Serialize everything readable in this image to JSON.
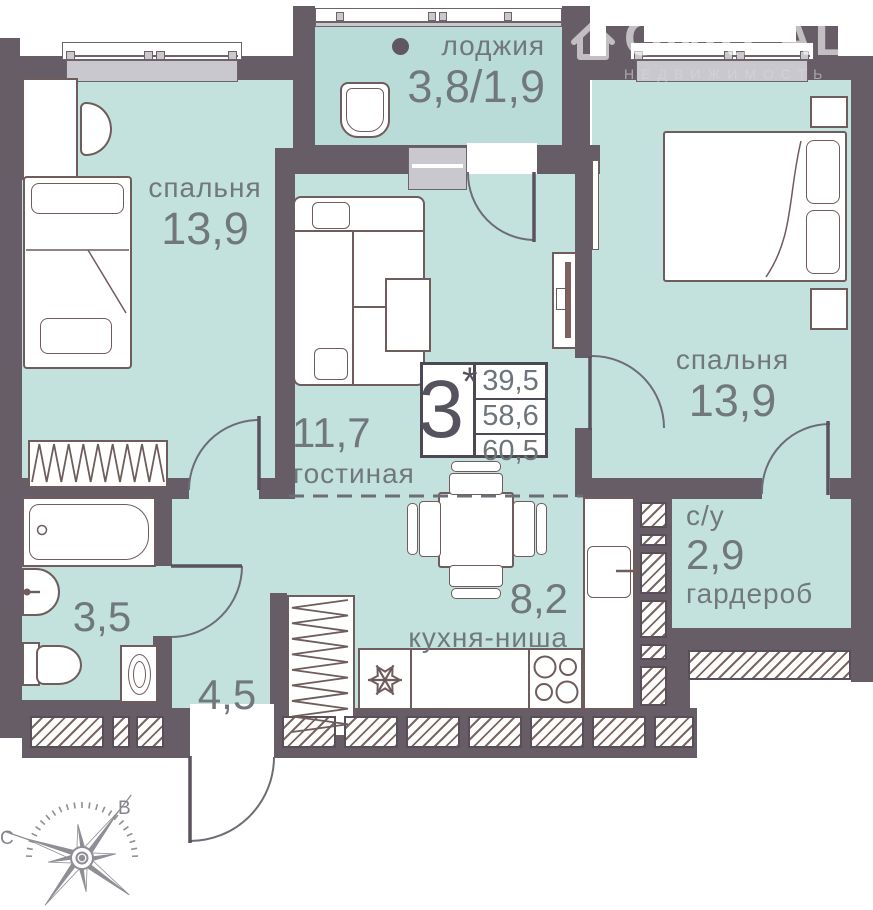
{
  "watermark": {
    "brand": "ONREAL",
    "subtitle": "НЕДВИЖИМОСТЬ"
  },
  "rooms": {
    "loggia": {
      "name": "лоджия",
      "area": "3,8/1,9"
    },
    "bedroom_left": {
      "name": "спальня",
      "area": "13,9"
    },
    "bedroom_right": {
      "name": "спальня",
      "area": "13,9"
    },
    "living_room": {
      "name": "гостиная",
      "area": "11,7"
    },
    "kitchen": {
      "name": "кухня-ниша",
      "area": "8,2"
    },
    "hallway": {
      "area": "4,5"
    },
    "bathroom": {
      "area": "3,5"
    },
    "wc_wardrobe": {
      "name": "с/у",
      "area": "2,9",
      "name2": "гардероб"
    }
  },
  "spec": {
    "rooms_count": "3",
    "star": "*",
    "area_living": "39,5",
    "area_no_balcony": "58,6",
    "area_total": "60,5"
  },
  "compass": {
    "north_label": "С",
    "east_label": "В"
  },
  "colors": {
    "wall": "#675d67",
    "floor": "#c3e2de",
    "loggia_floor": "#b9dcd8",
    "furniture_stroke": "#6f5c5c",
    "window_gray": "#c9c8cf",
    "text": "#71787c",
    "spec_dark": "#56525e"
  }
}
